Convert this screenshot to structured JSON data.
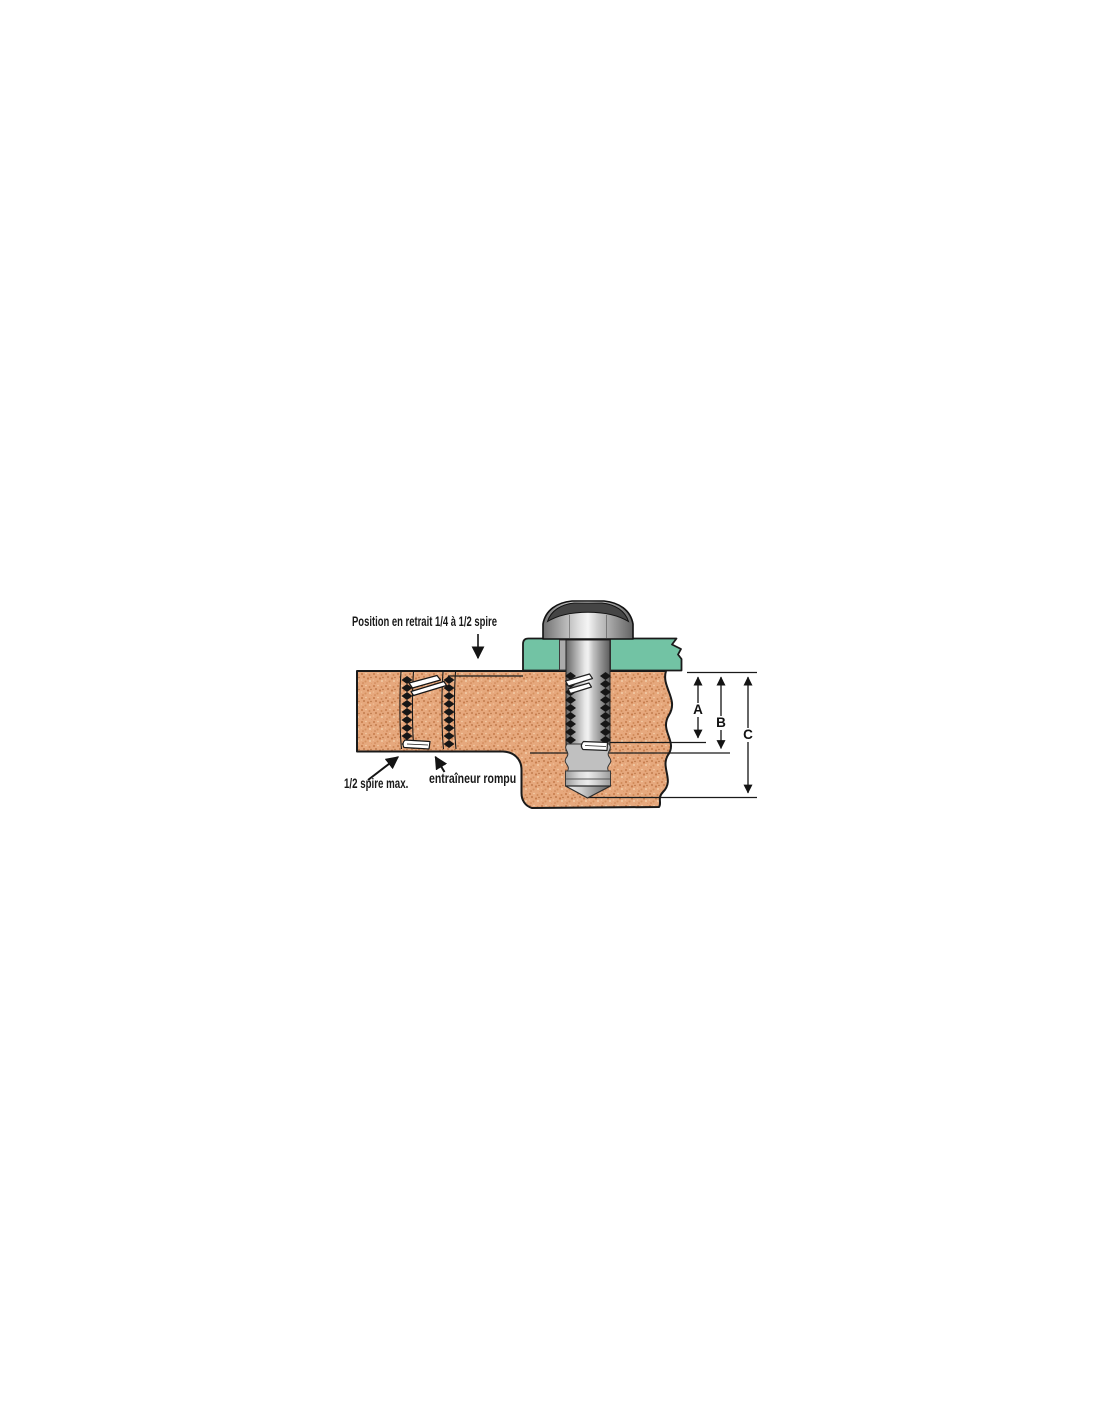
{
  "figure": {
    "type": "technical-cross-section-diagram",
    "labels": {
      "recess_position": "Position en retrait 1/4 à 1/2 spire",
      "half_coil_max": "1/2 spire max.",
      "broken_tang": "entraîneur rompu"
    },
    "dimensions": {
      "a": "A",
      "b": "B",
      "c": "C"
    },
    "colors": {
      "base_material": "#e6a87d",
      "clamped_plate": "#72c3a4",
      "insert_wire": "#161616",
      "outline": "#1a1a1a"
    }
  }
}
